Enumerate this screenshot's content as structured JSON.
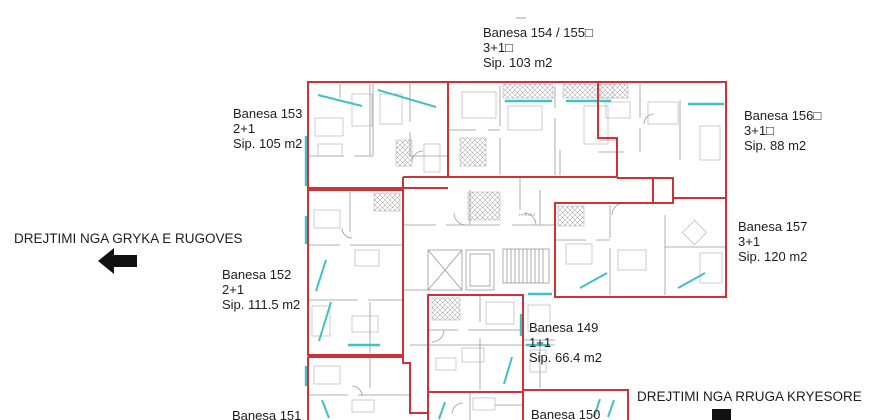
{
  "colors": {
    "red": "#cb3339",
    "cyan": "#3fc2c6",
    "gray": "#98989e",
    "fur": "#aaaab0",
    "ink": "#1d1d1d"
  },
  "apartments": [
    {
      "name": "Banesa 153",
      "rooms": "2+1",
      "area": "Sip. 105 m2"
    },
    {
      "name": "Banesa 154 / 155□",
      "rooms": "3+1□",
      "area": "Sip. 103 m2"
    },
    {
      "name": "Banesa 156□",
      "rooms": "3+1□",
      "area": "Sip. 88 m2"
    },
    {
      "name": "Banesa 157",
      "rooms": "3+1",
      "area": "Sip. 120 m2"
    },
    {
      "name": "Banesa 152",
      "rooms": "2+1",
      "area": "Sip. 111.5 m2"
    },
    {
      "name": "Banesa 149",
      "rooms": "1+1",
      "area": "Sip. 66.4 m2"
    },
    {
      "name": "Banesa 151"
    },
    {
      "name": "Banesa 150"
    }
  ],
  "directions": {
    "west": "DREJTIMI NGA GRYKA E RUGOVES",
    "south": "DREJTIMI NGA RRUGA KRYESORE"
  },
  "core": {
    "entrance_label": "HYRJA 2"
  }
}
